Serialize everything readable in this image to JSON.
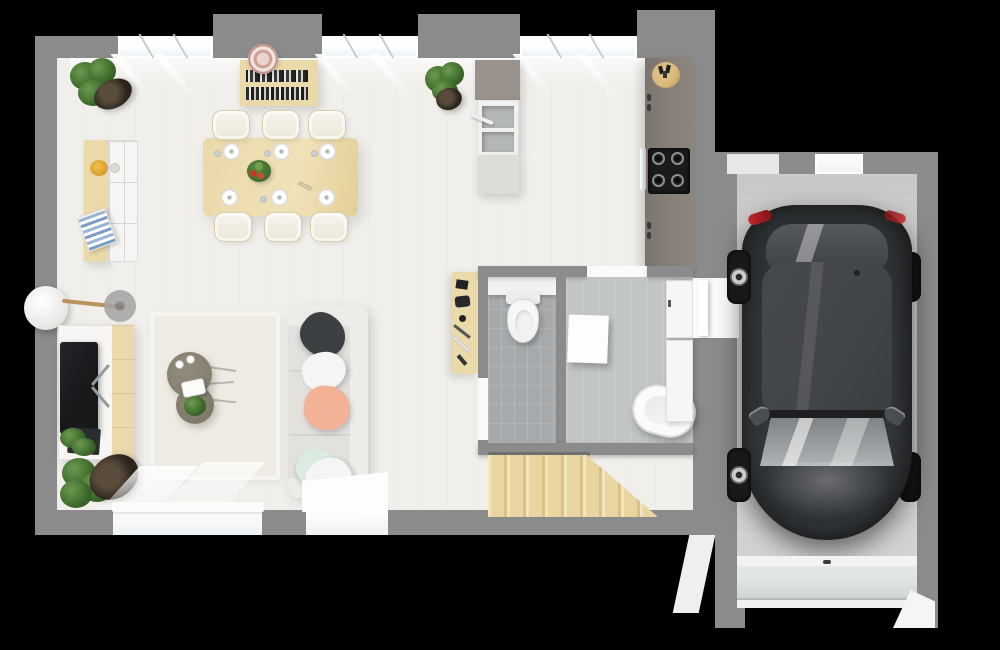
{
  "meta": {
    "kind": "3d-floor-plan-render",
    "view": "top-down",
    "background": "black",
    "canvas": {
      "width": 1000,
      "height": 650
    }
  },
  "palette": {
    "bg": "#000000",
    "wall": "#8b8b8b",
    "floor": "#f1efeb",
    "rug": "#eeebe3",
    "wood": "#ead9a9",
    "wood-dark": "#d9c289",
    "wood-light": "#f2e4bd",
    "cream": "#f6f4ee",
    "white": "#fafaf9",
    "counter": "#847d76",
    "island-top": "#99938b",
    "island-base": "#dedcd8",
    "cooktop": "#191b1d",
    "tile-wc": "#a7aaac",
    "tile-bath": "#c2c5c6",
    "sofa": "#e2e1de",
    "sofa-arm": "#edece9",
    "pillow-dark": "#3c4043",
    "pillow-peach": "#f3b295",
    "pillow-mint": "#dcebe2",
    "pillow-white": "#f5f5f3",
    "table-round": "#86806f",
    "tv": "#17181a",
    "plant": "#3f6d2d",
    "plant-light": "#6d9a50",
    "pot": "#2c251d",
    "magazine": "#7a9cc6",
    "bowl-yellow": "#f1c14c",
    "basket": "#d9b97c",
    "glass": "#e9f1f5",
    "stair": "#e9d5a0",
    "garage-floor": "#d2d3d1",
    "garage-door": "#dfe3e2",
    "car-body": "#33363a",
    "car-roof": "#42454a",
    "car-glass": "#aeb2b4",
    "car-glass-dark": "#55585c",
    "rim": "#c9cccd",
    "taillight": "#c2262a"
  },
  "rooms": [
    {
      "id": "dining-area"
    },
    {
      "id": "kitchen"
    },
    {
      "id": "living-room"
    },
    {
      "id": "wc"
    },
    {
      "id": "bathroom"
    },
    {
      "id": "stair-hall"
    },
    {
      "id": "garage"
    }
  ],
  "objects": {
    "shell": {
      "top_windows": 3,
      "sliding_glass_door": 1,
      "entry_door": 1,
      "garage_access_door": 1
    },
    "dining_area": {
      "table": {
        "material": "light-wood",
        "place_settings": 6,
        "centerpiece": "fruit-bowl"
      },
      "chairs": 6,
      "sideboard": {
        "items": [
          "yellow-bowl",
          "cup",
          "magazines"
        ]
      },
      "bookshelf": {
        "decor": "patterned-plate"
      },
      "corner_plants": 1
    },
    "kitchen": {
      "island": {
        "sink_basins": 2,
        "faucet": 1
      },
      "wall_counter": {
        "cooktop_burners": 4,
        "utensil_basket": 1,
        "oven": 1
      },
      "plant": 1
    },
    "living_room": {
      "sofa": {
        "pillows": [
          "dark",
          "white",
          "peach",
          "mint",
          "white"
        ]
      },
      "coffee_tables": 2,
      "tea_set": 1,
      "rug": 1,
      "tv_stand": {
        "tv": 1,
        "media_box": 1,
        "plant": 1
      },
      "floor_lamp": 1,
      "corner_plant": 1
    },
    "wc": {
      "toilet": 1,
      "floor": "grey-tile",
      "door": 1
    },
    "bathroom": {
      "bathtub": 1,
      "side_table": 1,
      "storage_cabinets": 2,
      "desk_with_accessories": 1
    },
    "stair_hall": {
      "staircase": {
        "material": "light-wood",
        "treads_visible": 7
      }
    },
    "garage": {
      "car": {
        "color": "dark-charcoal",
        "type": "hatchback"
      },
      "garage_door": 1,
      "window": 1
    }
  }
}
